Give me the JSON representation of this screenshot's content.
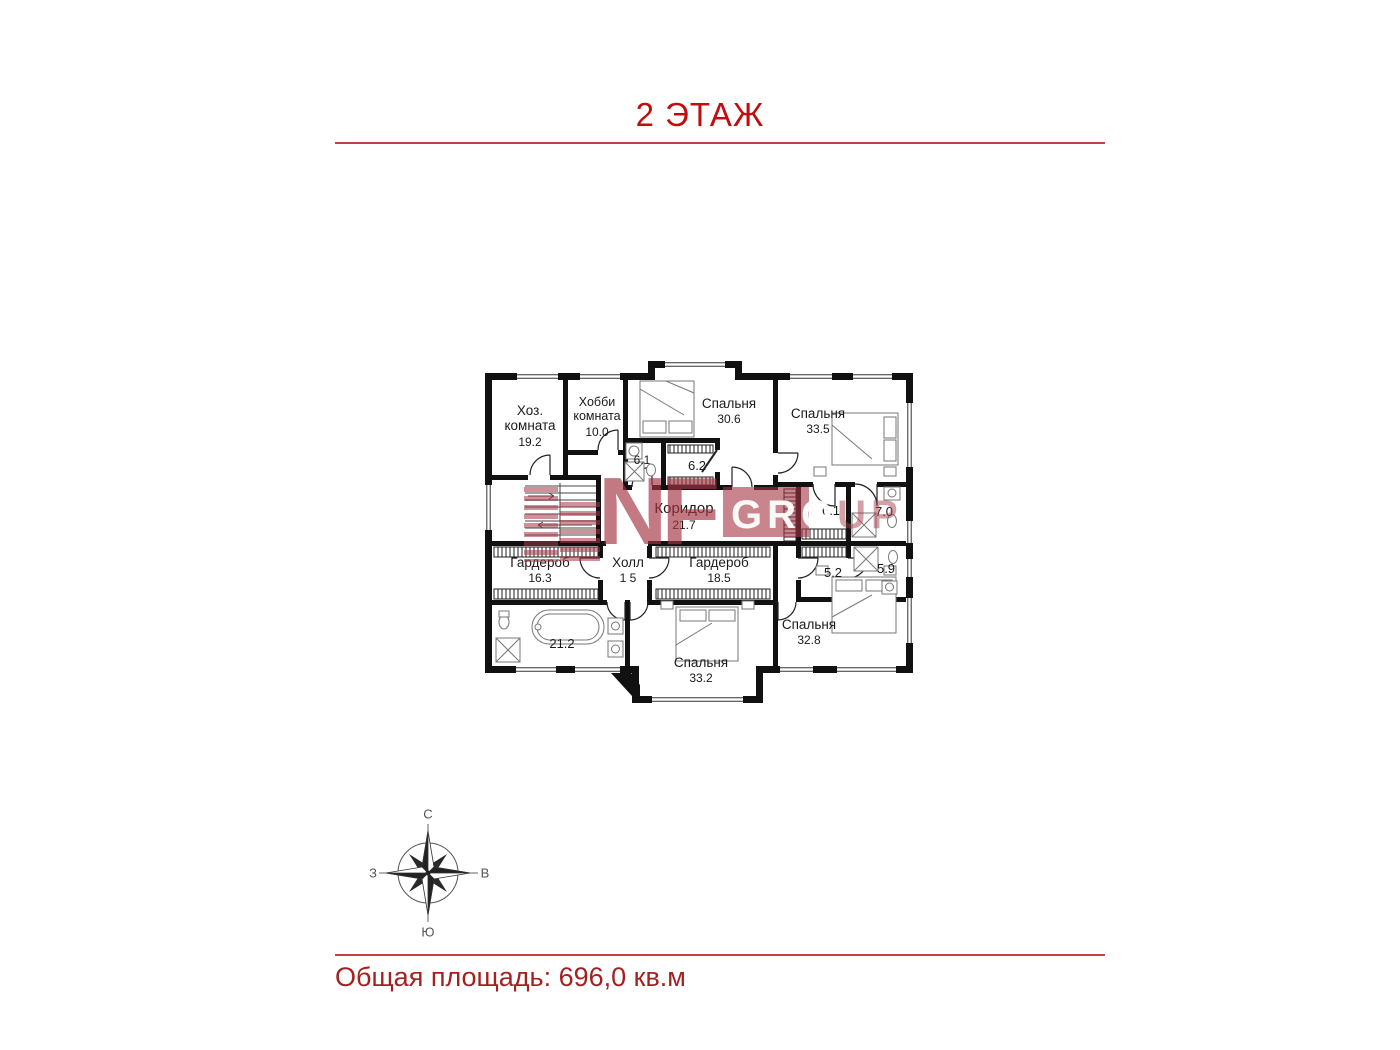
{
  "page": {
    "title": "2 ЭТАЖ",
    "footer_total": "Общая площадь: 696,0 кв.м"
  },
  "watermark": {
    "brand": "NF",
    "band_text": "GRO",
    "tail_text": "UP"
  },
  "compass": {
    "north": "С",
    "south": "Ю",
    "west": "З",
    "east": "В"
  },
  "plan": {
    "rooms": [
      {
        "id": "utility-room",
        "line1": "Хоз.",
        "line2": "комната",
        "area": "19.2"
      },
      {
        "id": "hobby-room",
        "line1": "Хобби",
        "line2": "комната",
        "area": "10.0"
      },
      {
        "id": "bedroom-30-6",
        "line1": "Спальня",
        "area": "30.6"
      },
      {
        "id": "bedroom-33-5",
        "line1": "Спальня",
        "area": "33.5"
      },
      {
        "id": "bath-6-1",
        "area": "6.1"
      },
      {
        "id": "closet-6-2",
        "area": "6.2"
      },
      {
        "id": "corridor",
        "line1": "Коридор",
        "area": "21.7"
      },
      {
        "id": "closet-6-1-right",
        "area": "6.1"
      },
      {
        "id": "bath-7-0",
        "area": "7.0"
      },
      {
        "id": "wardrobe-16-3",
        "line1": "Гардероб",
        "area": "16.3"
      },
      {
        "id": "hall",
        "line1": "Холл",
        "area": "1 5"
      },
      {
        "id": "wardrobe-18-5",
        "line1": "Гардероб",
        "area": "18.5"
      },
      {
        "id": "closet-5-2",
        "area": "5.2"
      },
      {
        "id": "bath-5-9",
        "area": "5.9"
      },
      {
        "id": "bath-21-2",
        "area": "21.2"
      },
      {
        "id": "bedroom-33-2",
        "line1": "Спальня",
        "area": "33.2"
      },
      {
        "id": "bedroom-32-8",
        "line1": "Спальня",
        "area": "32.8"
      }
    ]
  }
}
